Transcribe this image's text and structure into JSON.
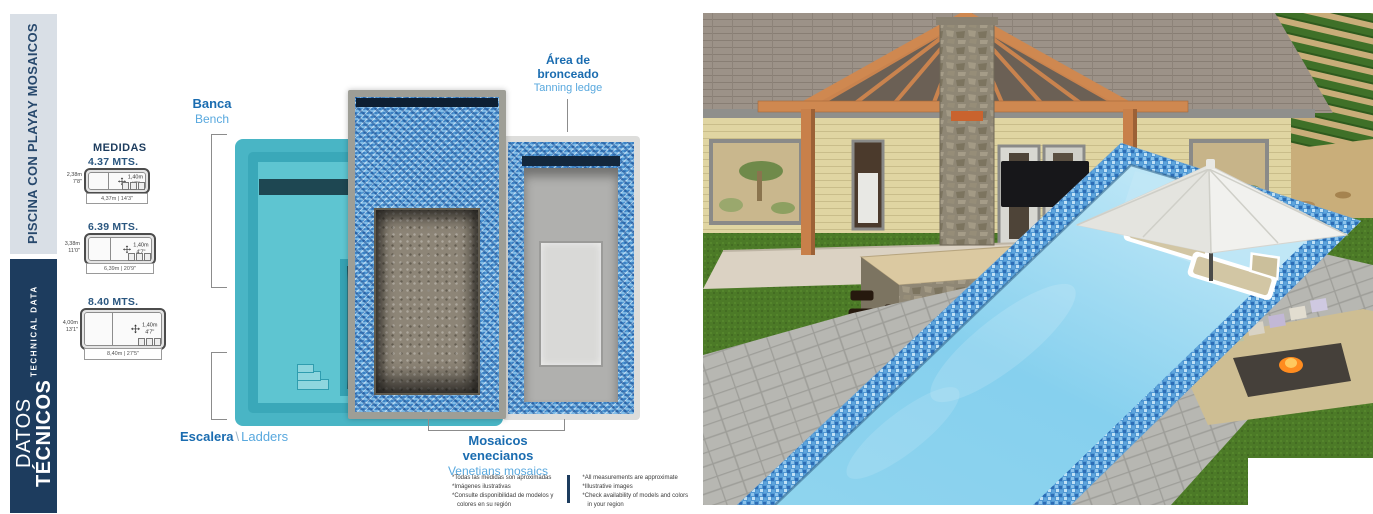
{
  "sidebar": {
    "title_line1": "PISCINA CON PLAYA",
    "title_line2": "Y MOSAICOS",
    "datos_regular": "DATOS ",
    "datos_bold": "TÉCNICOS",
    "technical_data": "TECHNICAL DATA"
  },
  "medidas": {
    "heading": "MEDIDAS",
    "models": [
      {
        "title": "4.37 MTS.",
        "width_m": "2,38m",
        "width_ft": "7'8\"",
        "depth_m": "1,40m",
        "depth_ft": "4'7\"",
        "length_label": "4,37m | 14'3\""
      },
      {
        "title": "6.39 MTS.",
        "width_m": "3,38m",
        "width_ft": "11'0\"",
        "depth_m": "1,40m",
        "depth_ft": "4'7\"",
        "length_label": "6,39m | 20'9\""
      },
      {
        "title": "8.40 MTS.",
        "width_m": "4,00m",
        "width_ft": "13'1\"",
        "depth_m": "1,40m",
        "depth_ft": "4'7\"",
        "length_label": "8,40m | 27'5\""
      }
    ]
  },
  "callouts": {
    "banca_es": "Banca",
    "banca_en": "Bench",
    "bronceado_es_line1": "Área de",
    "bronceado_es_line2": "bronceado",
    "bronceado_en": "Tanning ledge",
    "escalera_es": "Escalera",
    "escalera_sep": "\\",
    "escalera_en": "Ladders",
    "mosaicos_es_line1": "Mosaicos",
    "mosaicos_es_line2": "venecianos",
    "mosaicos_en": "Venetians mosaics"
  },
  "footnotes": {
    "es": [
      "*Todas las medidas son aproximadas",
      "*Imágenes ilustrativas",
      "*Consulte disponibilidad de modelos y",
      "colores en su región"
    ],
    "en": [
      "*All measurements are approximate",
      "*Illustrative images",
      "*Check availability of models and colors",
      "in your region"
    ]
  },
  "colors": {
    "navy": "#1d3c5e",
    "sidebar_light": "#d9dfe6",
    "label_blue": "#1a6cb0",
    "label_light_blue": "#58a8de",
    "teal": "#47b7c7",
    "mosaic_blue": "#4f97d3"
  }
}
